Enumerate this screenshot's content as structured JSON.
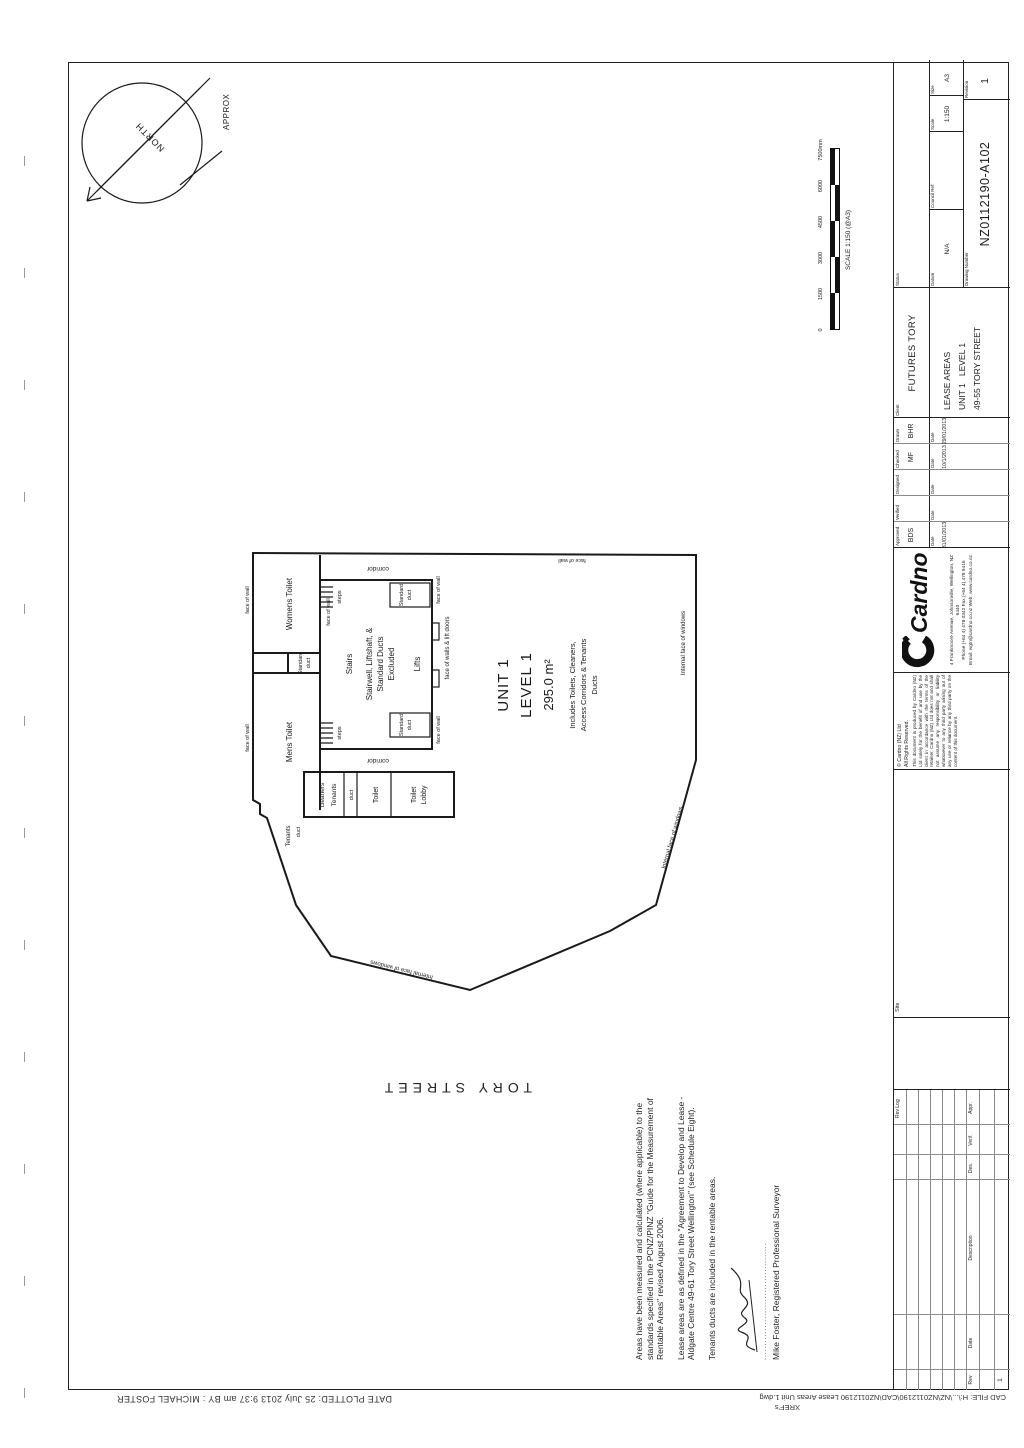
{
  "sheet": {
    "plotted": "DATE PLOTTED: 25 July 2013 9:37 am  BY : MICHAEL FOSTER",
    "cad_file": "CAD FILE: H:\\...\\NZ\\NZ0112190\\CAD\\NZ0112190 Lease Areas Unit 1.dwg",
    "xrefs": "XREF's"
  },
  "north": {
    "label": "NORTH",
    "approx": "APPROX"
  },
  "plan": {
    "street": "TORY STREET",
    "unit": {
      "line1": "UNIT 1",
      "line2": "LEVEL 1",
      "area": "295.0 m²",
      "inc1": "Includes Toilets, Cleaners,",
      "inc2": "Access Corridors & Tenants",
      "inc3": "Ducts"
    },
    "rooms": {
      "womens": "Womens Toilet",
      "mens": "Mens Toilet",
      "stairs": "Stairs",
      "sw1": "Stairwell, Liftshaft, &",
      "sw2": "Standard Ducts",
      "sw3": "Excluded",
      "lifts": "Lifts",
      "toilet": "Toilet",
      "lobby1": "Toilet",
      "lobby2": "Lobby",
      "cleaners": "cleaners",
      "tenants": "Tenants",
      "duct": "duct",
      "standard": "Standard",
      "corridor": "corridor",
      "steps": "steps"
    },
    "ann": {
      "fow": "face of wall",
      "fowld": "face of walls & lift doors",
      "ifw": "Internal face of windows"
    }
  },
  "notes": {
    "p1": "Areas have been measured and calculated (where applicable) to the standards specified in the PCNZ/PINZ \"Guide for the Measurement of Rentable Areas\" revised August 2006.",
    "p2": "Lease areas are as defined in the \"Agreement to Develop and Lease - Aldgate Centre 49-61 Tory Street Wellington\" (see Schedule Eight).",
    "p3": "Tenants ducts are included in the rentable areas.",
    "dots": "........................................",
    "surveyor": "Mike Foster, Registered Professional Surveyor"
  },
  "scale_bar": {
    "ticks": [
      "0",
      "1500",
      "3000",
      "4500",
      "6000",
      "7500mm"
    ],
    "caption": "SCALE 1:150 (@A3)"
  },
  "title_block": {
    "copyright": {
      "l1": "© Cardno (NZ) Ltd",
      "l2": "All Rights Reserved.",
      "body": "This document is produced by Cardno (NZ) Ltd solely for the benefit of and use by the client in accordance with the terms of the retainer. Cardno (NZ) Ltd does not and shall not assume any responsibility or liability whatsoever to any third party arising out of any use or reliance by any third party on the content of this document."
    },
    "logo": {
      "name": "Cardno",
      "addr1": "4 Frankmoore Avenue, Johnsonville, Wellington, NZ 6440",
      "addr2": "Phone (+64 4) 478 0342   Fax (+64 4) 478 9416",
      "addr3": "Email: wgtn@cardno.co.nz   Web: www.cardno.co.nz"
    },
    "date_label": "Date",
    "personnel": [
      {
        "role": "Approved",
        "name": "BDS",
        "date": "31/01/2013"
      },
      {
        "role": "Verified",
        "name": "",
        "date": ""
      },
      {
        "role": "Designed",
        "name": "",
        "date": ""
      },
      {
        "role": "Checked",
        "name": "MF",
        "date": "10/1/2013"
      },
      {
        "role": "Drawn",
        "name": "BHR",
        "date": "29/01/2013"
      }
    ],
    "client": {
      "label": "Client",
      "value": "FUTURES TORY"
    },
    "title": {
      "l1": "LEASE AREAS",
      "l2": "UNIT 1   LEVEL 1",
      "l3": "49-55 TORY STREET"
    },
    "status": {
      "label": "Status"
    },
    "datum": {
      "label": "Datum",
      "value": "N/A"
    },
    "council": {
      "label": "Council Ref:"
    },
    "scale": {
      "label": "Scale",
      "value": "1:150"
    },
    "size": {
      "label": "Size",
      "value": "A3"
    },
    "drawing_number": {
      "label": "Drawing Number",
      "value": "NZ0112190-A102"
    },
    "revision": {
      "label": "Revision",
      "value": "1"
    },
    "site_label": "Site",
    "rev_log": "Rev Log",
    "rev_table": {
      "headers": [
        "Rev",
        "Date",
        "Description",
        "Des.",
        "Verif.",
        "Appr."
      ],
      "rev1": "1"
    }
  }
}
